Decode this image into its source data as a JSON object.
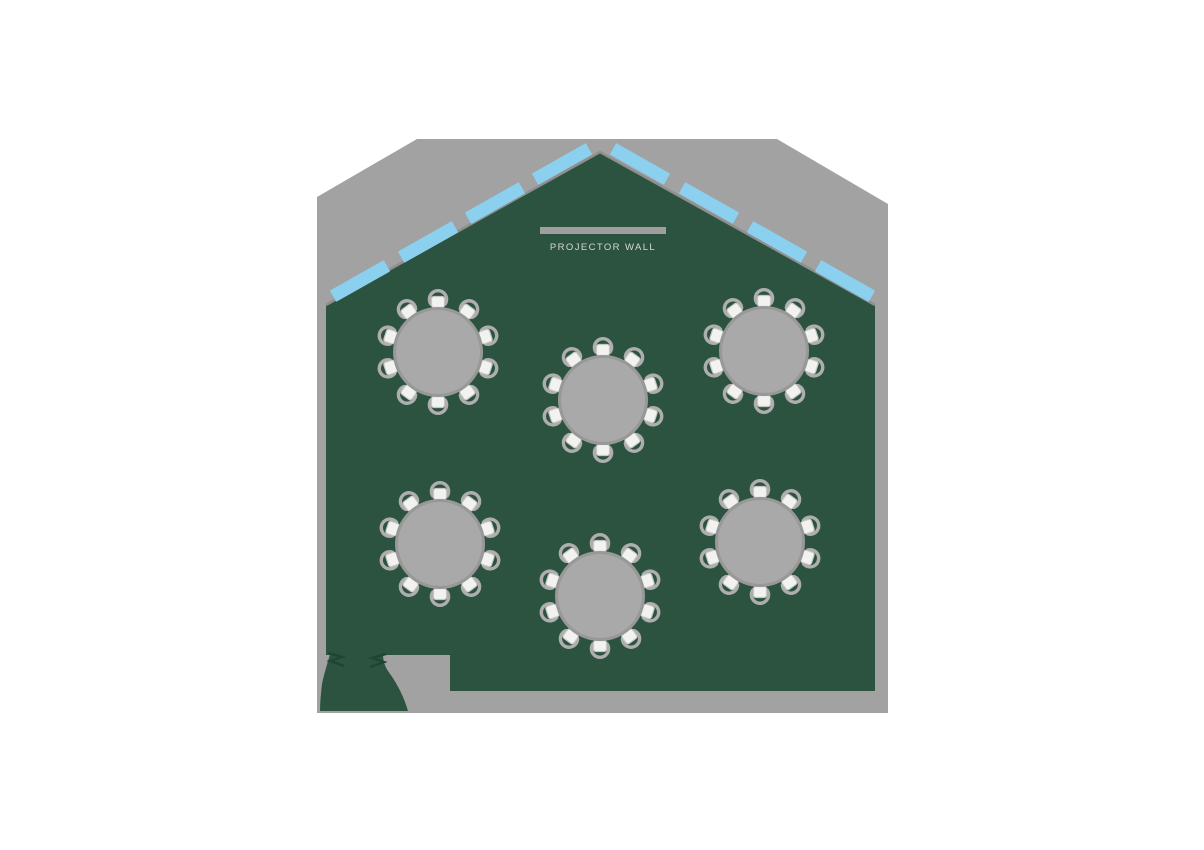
{
  "page": {
    "background": "#ffffff"
  },
  "colors": {
    "outer_wall_gray": "#a2a2a2",
    "room_green": "#2c5340",
    "roof_edge_line": "#8f8f8f",
    "skylight_blue": "#8bd0ee",
    "table_fill": "#a9a9a9",
    "table_rim": "#989898",
    "chair_seat": "#f2f2f0",
    "chair_seat_edge": "#c6c6c3",
    "chair_back": "#aeaeae",
    "projector_bar": "#9f9f9f",
    "label_text": "#d6d6d6",
    "door_mark": "#1e4434"
  },
  "projector_wall": {
    "label": "PROJECTOR WALL",
    "bar": {
      "x": 540,
      "y": 227,
      "width": 126,
      "height": 7
    },
    "label_pos": {
      "x": 603,
      "y": 250
    }
  },
  "floorplan": {
    "outer_wall_polygon": "317,197 417,139 777,139 888,204 888,713 317,713",
    "room_polygon": "326,305 600,152 875,305 875,691 450,691 450,655 326,655",
    "roofline_path": "M 326,305 L 600,152 L 875,305",
    "entry_vestibule_path": "M 330,654 C 327,665 324,674 322,684 C 321,693 320,702 320,711 L 408,711 C 404,697 397,683 388,671 C 384,665 383,659 383,654 Z",
    "door_marks": [
      "M 328,653 L 342,657 L 330,661 L 344,666",
      "M 386,654 L 372,658 L 384,662 L 370,667"
    ],
    "skylights": {
      "count": 8,
      "length": 62,
      "thickness": 13,
      "items": [
        {
          "cx": 360,
          "cy": 281,
          "angle": -29.5
        },
        {
          "cx": 428,
          "cy": 242,
          "angle": -29.5
        },
        {
          "cx": 495,
          "cy": 203,
          "angle": -29.5
        },
        {
          "cx": 562,
          "cy": 164,
          "angle": -29.5
        },
        {
          "cx": 640,
          "cy": 164,
          "angle": 29.5
        },
        {
          "cx": 709,
          "cy": 203,
          "angle": 29.5
        },
        {
          "cx": 777,
          "cy": 242,
          "angle": 29.5
        },
        {
          "cx": 845,
          "cy": 281,
          "angle": 29.5
        }
      ]
    },
    "tables": {
      "count": 6,
      "chairs_per_table": 10,
      "table_radius": 43.5,
      "chair_ring_radius": 50,
      "first_chair_angle_deg": -90,
      "positions": [
        {
          "cx": 438,
          "cy": 352
        },
        {
          "cx": 603,
          "cy": 400
        },
        {
          "cx": 764,
          "cy": 351
        },
        {
          "cx": 440,
          "cy": 544
        },
        {
          "cx": 600,
          "cy": 596
        },
        {
          "cx": 760,
          "cy": 542
        }
      ]
    }
  }
}
